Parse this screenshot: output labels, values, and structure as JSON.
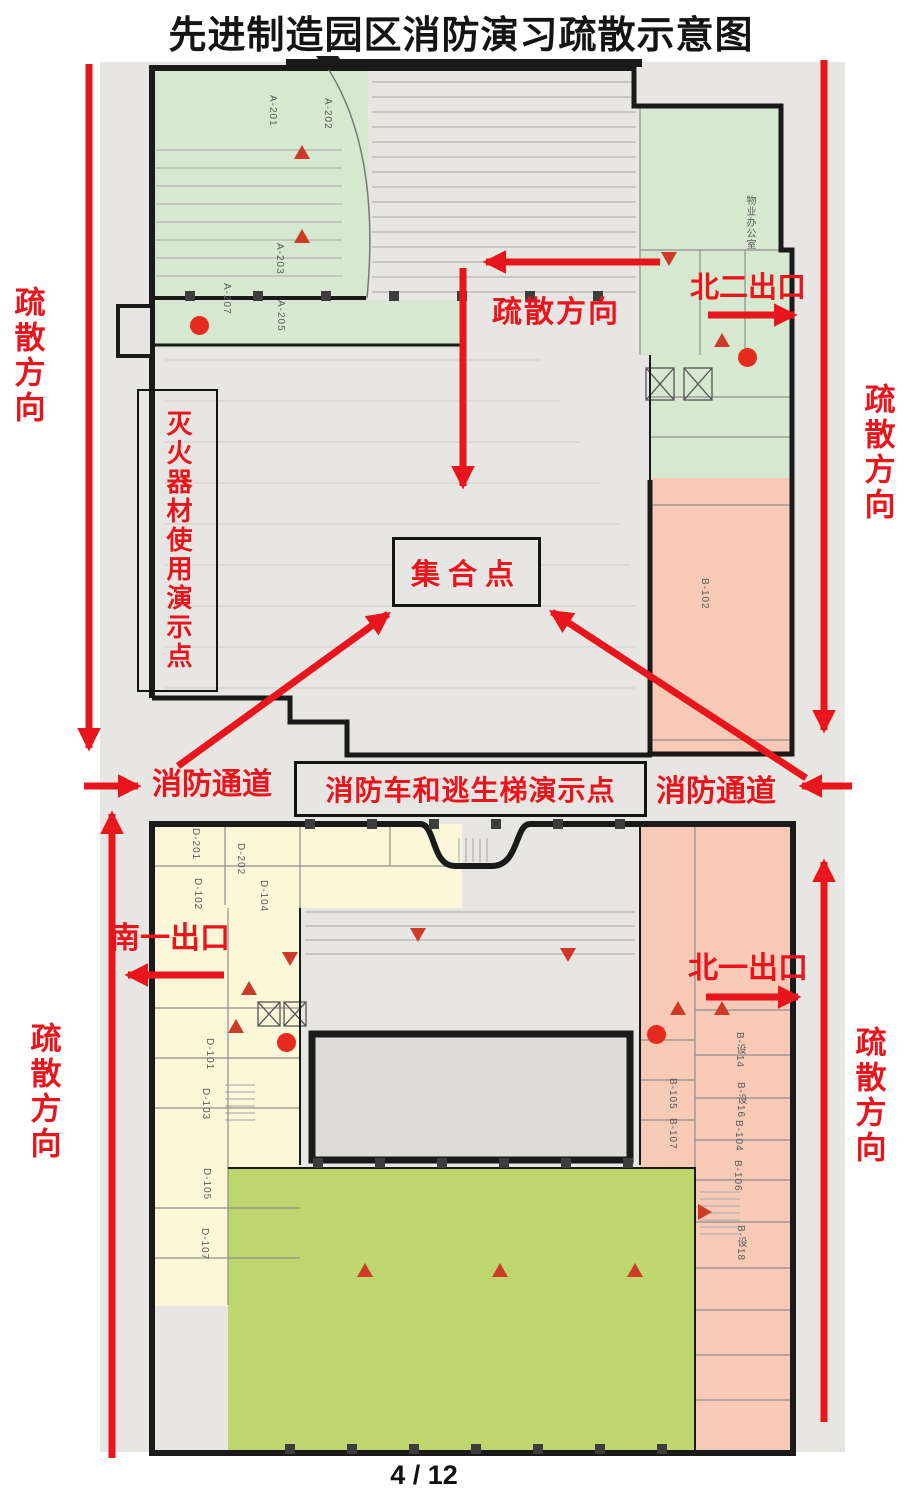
{
  "page": {
    "title": "先进制造园区消防演习疏散示意图",
    "page_number": "4 / 12"
  },
  "colors": {
    "annotation_red": "#e8151d",
    "wall_black": "#1a1a1a",
    "plan_background": "#e8e6e3",
    "zone_green": "#d7e8d0",
    "zone_pink": "#f6cab7",
    "zone_yellow": "#fbf7d8",
    "zone_olive": "#bed66e",
    "marker_red": "#cd3a28"
  },
  "annotations": {
    "left_top_direction": "疏散方向",
    "left_bottom_direction": "疏散方向",
    "right_top_direction": "疏散方向",
    "right_bottom_direction": "疏散方向",
    "center_direction": "疏散方向",
    "north_exit_2": "北二出口",
    "north_exit_1": "北一出口",
    "south_exit_1": "南一出口",
    "fire_lane_left": "消防通道",
    "fire_lane_right": "消防通道",
    "assembly_point": "集合点",
    "extinguisher_demo_point": "灭火器材使用演示点",
    "fire_truck_ladder_demo_point": "消防车和逃生梯演示点"
  },
  "plan": {
    "rooms": [
      {
        "label": "A-201",
        "x": 267,
        "y": 95
      },
      {
        "label": "A-202",
        "x": 322,
        "y": 98
      },
      {
        "label": "A-203",
        "x": 274,
        "y": 243
      },
      {
        "label": "A-207",
        "x": 221,
        "y": 283
      },
      {
        "label": "A-205",
        "x": 275,
        "y": 300
      },
      {
        "label": "物业办公室",
        "x": 742,
        "y": 195
      },
      {
        "label": "B-102",
        "x": 699,
        "y": 578
      },
      {
        "label": "D-201",
        "x": 190,
        "y": 828
      },
      {
        "label": "D-202",
        "x": 235,
        "y": 843
      },
      {
        "label": "D-102",
        "x": 192,
        "y": 878
      },
      {
        "label": "D-104",
        "x": 258,
        "y": 880
      },
      {
        "label": "D-101",
        "x": 204,
        "y": 1038
      },
      {
        "label": "D-103",
        "x": 200,
        "y": 1088
      },
      {
        "label": "D-105",
        "x": 201,
        "y": 1168
      },
      {
        "label": "D-107",
        "x": 199,
        "y": 1228
      },
      {
        "label": "B-设14",
        "x": 732,
        "y": 1032
      },
      {
        "label": "B-105",
        "x": 667,
        "y": 1078
      },
      {
        "label": "B-设16",
        "x": 733,
        "y": 1082
      },
      {
        "label": "B-107",
        "x": 667,
        "y": 1118
      },
      {
        "label": "B-104",
        "x": 733,
        "y": 1120
      },
      {
        "label": "B-106",
        "x": 732,
        "y": 1160
      },
      {
        "label": "B-设18",
        "x": 733,
        "y": 1225
      }
    ],
    "extinguisher_points": [
      {
        "x": 190,
        "y": 316
      },
      {
        "x": 738,
        "y": 348
      },
      {
        "x": 277,
        "y": 1033
      },
      {
        "x": 647,
        "y": 1025
      }
    ],
    "alarm_markers": [
      {
        "x": 294,
        "y": 145,
        "dir": "up"
      },
      {
        "x": 294,
        "y": 229,
        "dir": "up"
      },
      {
        "x": 661,
        "y": 252,
        "dir": "down"
      },
      {
        "x": 714,
        "y": 333,
        "dir": "up"
      },
      {
        "x": 670,
        "y": 1001,
        "dir": "up"
      },
      {
        "x": 714,
        "y": 1001,
        "dir": "up"
      },
      {
        "x": 282,
        "y": 952,
        "dir": "down"
      },
      {
        "x": 241,
        "y": 981,
        "dir": "up"
      },
      {
        "x": 228,
        "y": 1019,
        "dir": "up"
      },
      {
        "x": 410,
        "y": 928,
        "dir": "down"
      },
      {
        "x": 560,
        "y": 948,
        "dir": "down"
      },
      {
        "x": 357,
        "y": 1263,
        "dir": "up"
      },
      {
        "x": 492,
        "y": 1263,
        "dir": "up"
      },
      {
        "x": 627,
        "y": 1263,
        "dir": "up"
      },
      {
        "x": 698,
        "y": 1204,
        "dir": "right"
      }
    ]
  }
}
